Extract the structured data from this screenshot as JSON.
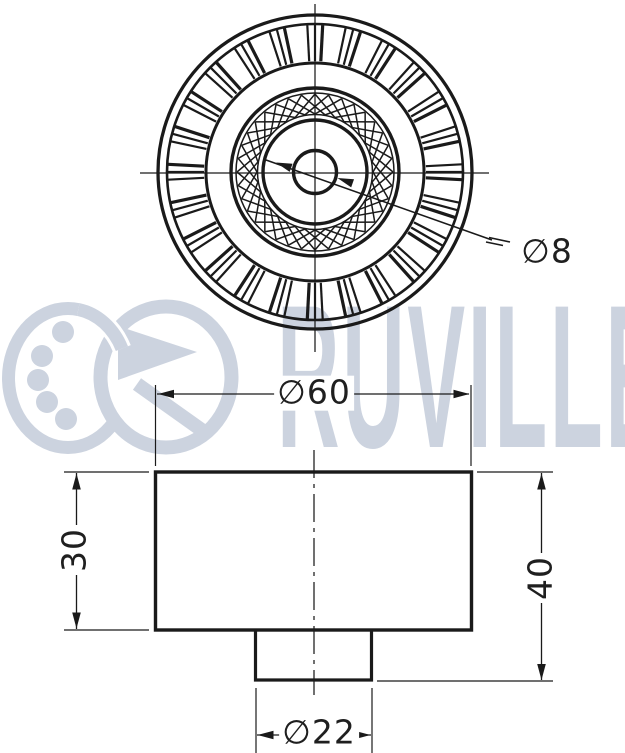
{
  "watermark": {
    "brand": "RUVILLE"
  },
  "dimensions": {
    "pulley_outer_diameter": "∅60",
    "bore_diameter": "∅8",
    "hub_diameter": "∅22",
    "body_width": "30",
    "overall_width": "40"
  },
  "colors": {
    "line": "#1a1a1a",
    "watermark": "#ccd3df",
    "background": "#ffffff"
  }
}
